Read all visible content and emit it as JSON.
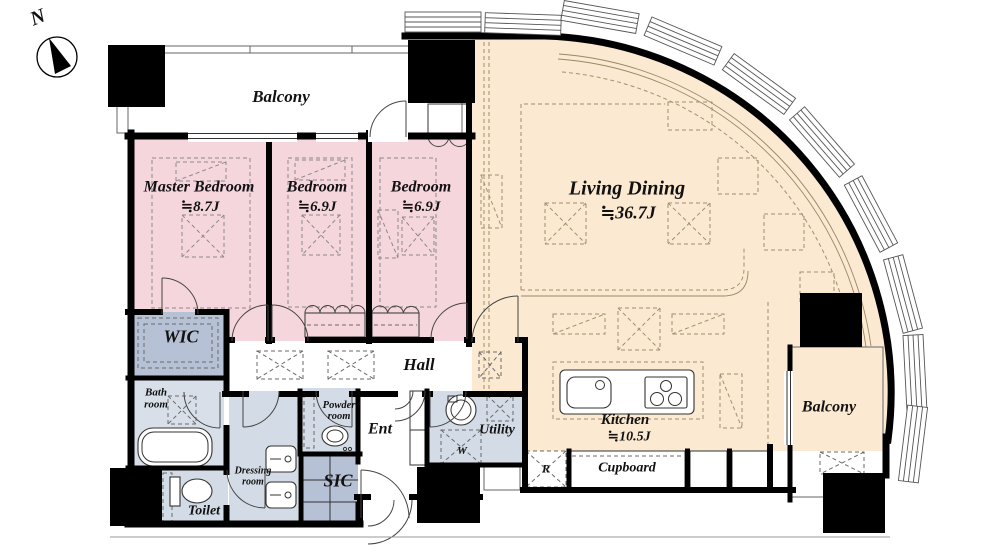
{
  "floor_plan": {
    "compass": {
      "north_label": "N"
    },
    "rooms": {
      "balcony_top": {
        "name": "Balcony"
      },
      "master_bedroom": {
        "name": "Master Bedroom",
        "area": "≒8.7J"
      },
      "bedroom_center": {
        "name": "Bedroom",
        "area": "≒6.9J"
      },
      "bedroom_right": {
        "name": "Bedroom",
        "area": "≒6.9J"
      },
      "living_dining": {
        "name": "Living Dining",
        "area": "≒36.7J"
      },
      "kitchen": {
        "name": "Kitchen",
        "area": "≒10.5J"
      },
      "wic": {
        "name": "WIC"
      },
      "hall": {
        "name": "Hall"
      },
      "bath_room": {
        "line1": "Bath",
        "line2": "room"
      },
      "toilet": {
        "name": "Toilet"
      },
      "dressing_room": {
        "line1": "Dressing",
        "line2": "room"
      },
      "powder_room": {
        "line1": "Powder",
        "line2": "room"
      },
      "ent": {
        "name": "Ent"
      },
      "sic": {
        "name": "SIC"
      },
      "utility": {
        "name": "Utility"
      },
      "washer_space": {
        "abbr": "W"
      },
      "refrigerator_space": {
        "abbr": "R"
      },
      "cupboard": {
        "name": "Cupboard"
      },
      "balcony_right": {
        "name": "Balcony"
      }
    },
    "colors": {
      "bedroom_pink": "#f6d6dd",
      "living_tan": "#fbe9d1",
      "closet_blue": "#b6c1d5",
      "wet_room_blue": "#d3dbe6",
      "cabinet_blue": "#b2bfd5",
      "wall_black": "#000000"
    }
  }
}
